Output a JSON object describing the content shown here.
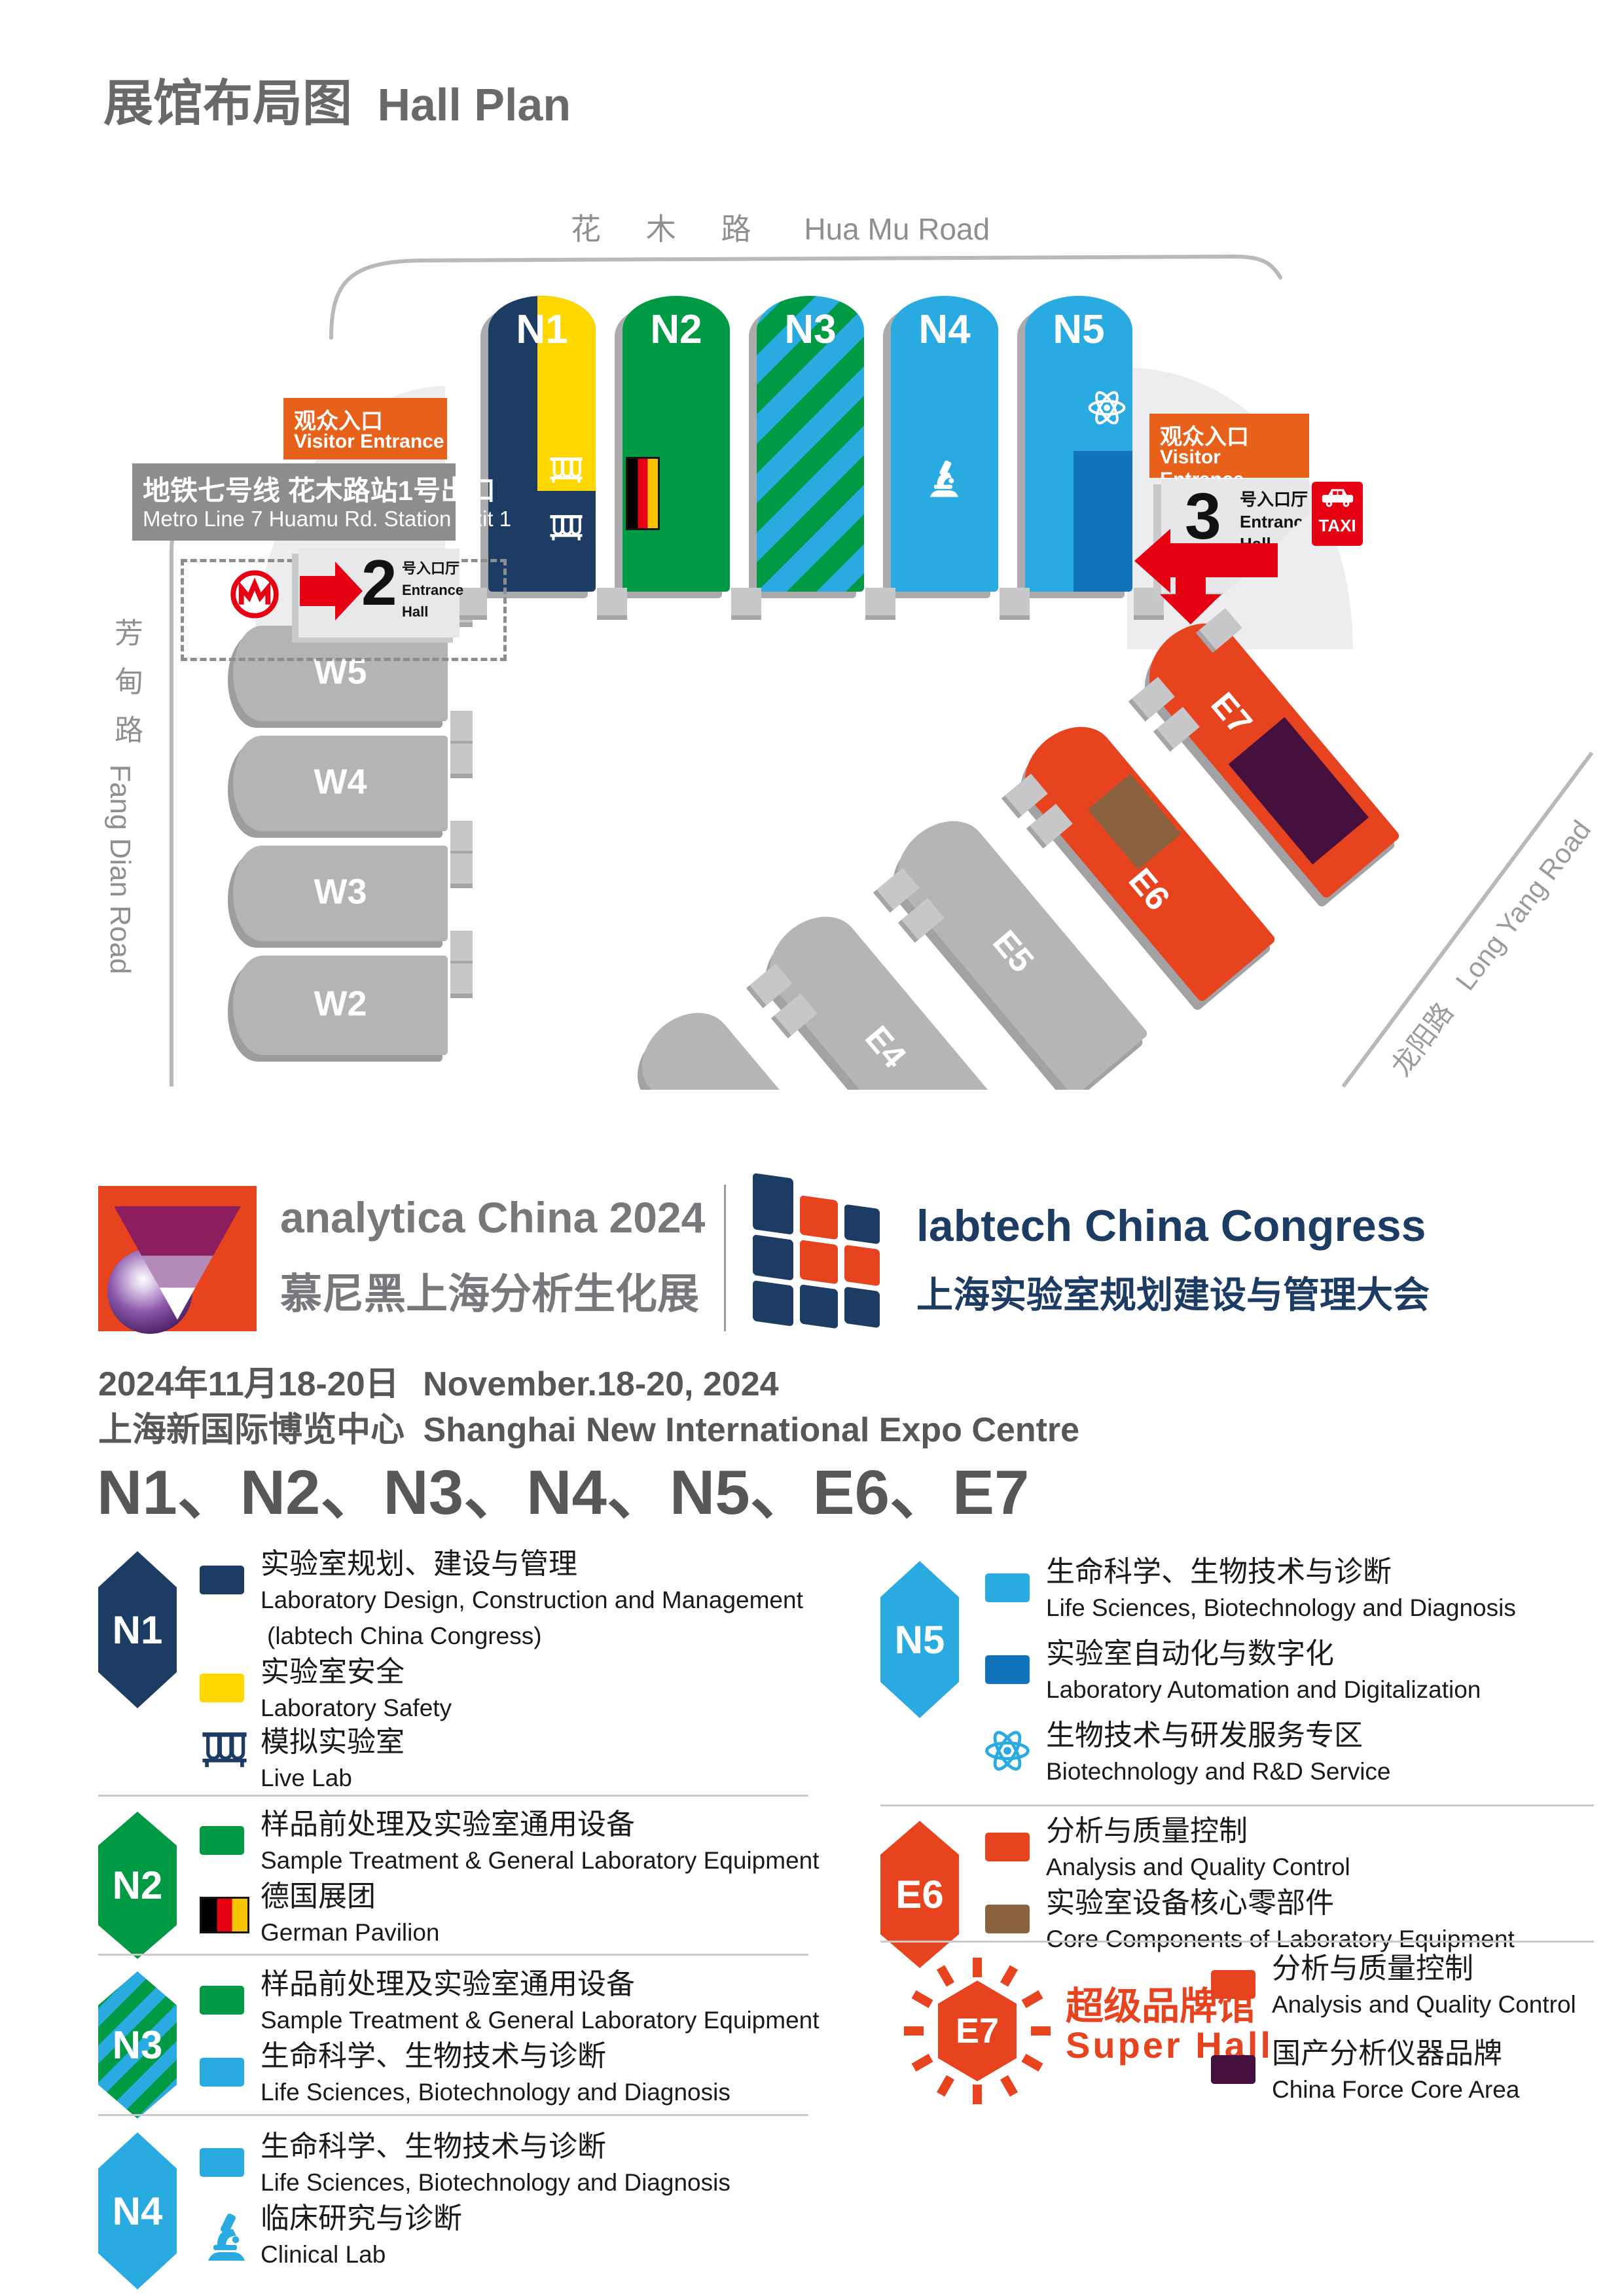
{
  "page": {
    "title_cn": "展馆布局图",
    "title_en": "Hall Plan"
  },
  "map": {
    "roads": {
      "huamu_cn": "花 木 路",
      "huamu_en": "Hua Mu Road",
      "fangdian_cn": "芳甸路",
      "fangdian_en": "Fang Dian Road",
      "longyang_cn": "龙阳路",
      "longyang_en": "Long Yang Road"
    },
    "metro": {
      "line_cn": "地铁七号线 花木路站1号出口",
      "line_en": "Metro Line 7  Huamu Rd. Station Exit 1"
    },
    "entrances": {
      "visitor_cn": "观众入口",
      "visitor_en": "Visitor Entrance",
      "hall2_num": "2",
      "hall3_num": "3",
      "hall_cn": "号入口厅",
      "hall_en1": "Entrance",
      "hall_en2": "Hall",
      "taxi": "TAXI"
    },
    "halls": {
      "n1": "N1",
      "n2": "N2",
      "n3": "N3",
      "n4": "N4",
      "n5": "N5",
      "w2": "W2",
      "w3": "W3",
      "w4": "W4",
      "w5": "W5",
      "e3": "E3",
      "e4": "E4",
      "e5": "E5",
      "e6": "E6",
      "e7": "E7"
    }
  },
  "branding": {
    "analytica": {
      "name": "analytica China 2024",
      "cn": "慕尼黑上海分析生化展"
    },
    "labtech": {
      "name": "labtech China Congress",
      "cn": "上海实验室规划建设与管理大会"
    }
  },
  "event": {
    "date_cn": "2024年11月18-20日",
    "date_en": "November.18-20, 2024",
    "venue_cn": "上海新国际博览中心",
    "venue_en": "Shanghai New International Expo Centre",
    "halls_line": "N1、N2、N3、N4、N5、E6、E7"
  },
  "legend": {
    "n1": {
      "badge": "N1",
      "items": [
        {
          "cn": "实验室规划、建设与管理",
          "en": "Laboratory Design, Construction and Management",
          "en2": "(labtech China Congress)"
        },
        {
          "cn": "实验室安全",
          "en": "Laboratory Safety"
        },
        {
          "cn": "模拟实验室",
          "en": "Live Lab"
        }
      ]
    },
    "n2": {
      "badge": "N2",
      "items": [
        {
          "cn": "样品前处理及实验室通用设备",
          "en": "Sample Treatment & General Laboratory Equipment"
        },
        {
          "cn": "德国展团",
          "en": "German Pavilion"
        }
      ]
    },
    "n3": {
      "badge": "N3",
      "items": [
        {
          "cn": "样品前处理及实验室通用设备",
          "en": "Sample Treatment & General Laboratory Equipment"
        },
        {
          "cn": "生命科学、生物技术与诊断",
          "en": "Life Sciences, Biotechnology and Diagnosis"
        }
      ]
    },
    "n4": {
      "badge": "N4",
      "items": [
        {
          "cn": "生命科学、生物技术与诊断",
          "en": "Life Sciences, Biotechnology and Diagnosis"
        },
        {
          "cn": "临床研究与诊断",
          "en": "Clinical Lab"
        }
      ]
    },
    "n5": {
      "badge": "N5",
      "items": [
        {
          "cn": "生命科学、生物技术与诊断",
          "en": "Life Sciences, Biotechnology and Diagnosis"
        },
        {
          "cn": "实验室自动化与数字化",
          "en": "Laboratory Automation and Digitalization"
        },
        {
          "cn": "生物技术与研发服务专区",
          "en": "Biotechnology and R&D Service"
        }
      ]
    },
    "e6": {
      "badge": "E6",
      "items": [
        {
          "cn": "分析与质量控制",
          "en": "Analysis and Quality Control"
        },
        {
          "cn": "实验室设备核心零部件",
          "en": "Core Components of Laboratory Equipment"
        }
      ]
    },
    "e7": {
      "badge": "E7",
      "super_cn": "超级品牌馆",
      "super_en": "Super Hall",
      "items": [
        {
          "cn": "分析与质量控制",
          "en": "Analysis and Quality Control"
        },
        {
          "cn": "国产分析仪器品牌",
          "en": "China Force Core Area"
        }
      ]
    }
  },
  "colors": {
    "navy": "#1d3c63",
    "yellow": "#ffd800",
    "green": "#009a44",
    "light_blue": "#29abe2",
    "dark_blue": "#1173b9",
    "orange_red": "#e8431f",
    "entrance_orange": "#e8611a",
    "brown": "#8a6240",
    "purple": "#45103e",
    "taxi_red": "#e60012",
    "gray_hall": "#b4b4b6"
  }
}
